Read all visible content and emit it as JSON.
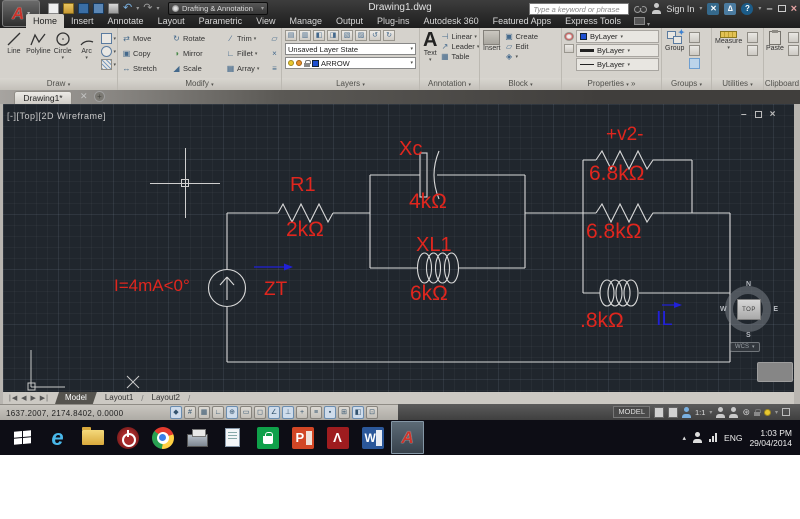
{
  "titlebar": {
    "workspace": "Drafting & Annotation",
    "title": "Drawing1.dwg",
    "search_placeholder": "Type a keyword or phrase",
    "sign_in": "Sign In"
  },
  "ribbon": {
    "tabs": [
      "Home",
      "Insert",
      "Annotate",
      "Layout",
      "Parametric",
      "View",
      "Manage",
      "Output",
      "Plug-ins",
      "Autodesk 360",
      "Featured Apps",
      "Express Tools"
    ],
    "draw": {
      "label": "Draw",
      "buttons": [
        "Line",
        "Polyline",
        "Circle",
        "Arc"
      ]
    },
    "modify": {
      "label": "Modify",
      "buttons": [
        "Move",
        "Rotate",
        "Trim",
        "Copy",
        "Mirror",
        "Fillet",
        "Stretch",
        "Scale",
        "Array"
      ]
    },
    "layers": {
      "label": "Layers",
      "state_combo": "Unsaved Layer State",
      "layer_combo": "ARROW"
    },
    "annotation": {
      "label": "Annotation",
      "text": "Text",
      "linear": "Linear",
      "leader": "Leader",
      "table": "Table"
    },
    "block": {
      "label": "Block",
      "insert": "Insert",
      "create": "Create",
      "edit": "Edit"
    },
    "properties": {
      "label": "Properties",
      "color": "ByLayer",
      "lineweight": "ByLayer",
      "linetype": "ByLayer"
    },
    "groups": {
      "label": "Groups",
      "group": "Group"
    },
    "utilities": {
      "label": "Utilities",
      "measure": "Measure"
    },
    "clipboard": {
      "label": "Clipboard",
      "paste": "Paste"
    }
  },
  "file_tab": {
    "name": "Drawing1*"
  },
  "viewport": {
    "label": "[-][Top][2D Wireframe]"
  },
  "circuit": {
    "source_label": "I=4mA<0°",
    "zt_label": "ZT",
    "r1_name": "R1",
    "r1_value": "2kΩ",
    "xc_name": "Xc",
    "xc_value": "4kΩ",
    "xl1_name": "XL1",
    "xl1_value": "6kΩ",
    "v2_label": "+v2-",
    "r2_value": "6.8kΩ",
    "r3_value": "6.8kΩ",
    "l2_value": ".8kΩ",
    "il_label": "IL"
  },
  "viewcube": {
    "north": "N",
    "east": "E",
    "south": "S",
    "west": "W",
    "face": "TOP",
    "wcs": "WCS"
  },
  "layout_tabs": {
    "model": "Model",
    "layout1": "Layout1",
    "layout2": "Layout2"
  },
  "statusbar": {
    "coordinates": "1637.2007, 2174.8402, 0.0000",
    "model_label": "MODEL",
    "annotation_scale": "1:1"
  },
  "taskbar": {
    "language": "ENG",
    "time": "1:03 PM",
    "date": "29/04/2014"
  },
  "colors": {
    "label_red": "#e0261e",
    "label_blue": "#2121d8",
    "canvas_bg": "#20262d",
    "wire": "#d9d9d9",
    "accent_red": "#c8322a"
  }
}
